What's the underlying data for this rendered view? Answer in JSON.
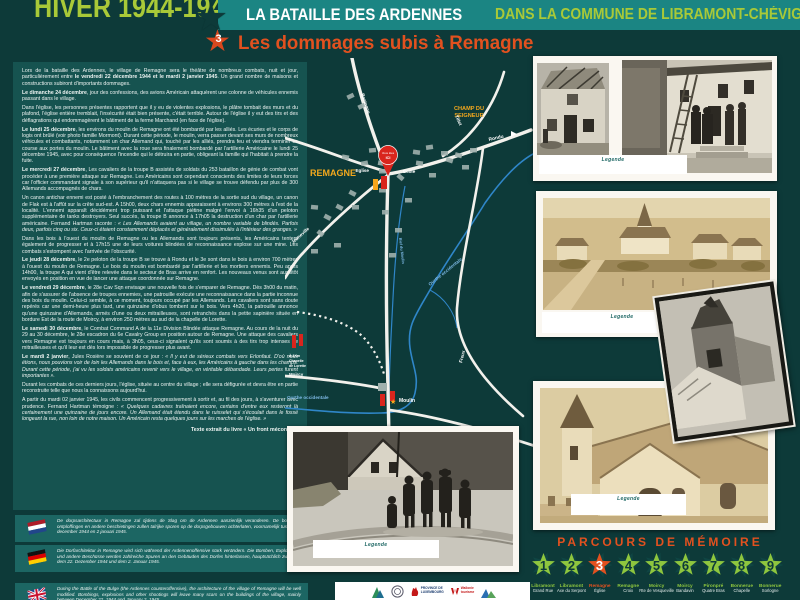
{
  "header": {
    "season_title": "HIVER 1944-1945",
    "battle_title": "LA BATAILLE DES ARDENNES",
    "commune_title": "DANS LA COMMUNE DE LIBRAMONT-CHÉVIGNY",
    "stop_number": "3",
    "page_title": "Les dommages subis à Remagne"
  },
  "article": {
    "paragraphs": [
      {
        "pre": "Lors de la bataille des Ardennes, le village de Remagne sera le théâtre de nombreux combats, nuit et jour, particulièrement entre ",
        "lead": "le vendredi 22 décembre 1944 et le mardi 2 janvier 1945",
        "text": ". Un grand nombre de maisons et constructions subiront d'importants dommages.",
        "quote": ""
      },
      {
        "pre": "",
        "lead": "Le dimanche 24 décembre",
        "text": ", jour des confessions, des avions Américain attaquèrent une colonne de véhicules ennemis passant dans le village.",
        "quote": ""
      },
      {
        "pre": "",
        "lead": "",
        "text": "Dans l'église, les personnes présentes rapportent que il y eu de violentes explosions, le plâtre tombait des murs et du plafond, l'église entière tremblait, l'insécurité était bien présente, c'était terrible. Autour de l'église il y eut des tirs et des déflagrations qui endommagèrent le bâtiment de la ferme Marchand (en face de l'église).",
        "quote": ""
      },
      {
        "pre": "",
        "lead": "Le lundi 25 décembre",
        "text": ", les environs du moulin de Remagne ont été bombardé par les alliés. Les écuries et le corps de logis ont brûlé (voir photo famille Mormont). Durant cette période, le moulin, verra passer devant ses murs de nombreux véhicules et combattants, notamment un char Allemand qui, touché par les alliés, prendra feu et viendra terminer sa course aux portes du moulin. Le bâtiment avec la roue sera finalement bombardé par l'artillerie Américaine le lundi 25 décembre 1945, avec pour conséquence l'incendie qui le détruira en partie, obligeant la famille qui l'habitait à prendre la fuite.",
        "quote": ""
      },
      {
        "pre": "",
        "lead": "Le mercredi 27 décembre",
        "text": ", Les cavaliers de la troupe B assistés de soldats du 253 bataillon de génie de combat vont procéder à une première attaque sur Remagne. Les Américains sont cependant conscients des limites de leurs forces car l'officier commandant signale à son supérieur qu'il n'attaquera pas si le village se trouve défendu par plus de 300 Allemands accompagnés de chars.",
        "quote": ""
      },
      {
        "pre": "",
        "lead": "",
        "text": "Un canon antichar ennemi est posté à l'embranchement des routes à 100 mètres de la sortie sud du village, un canon de Flak est à l'affût sur la crête sud-est. A 15h00, deux chars ennemis apparaissent à environs 300 mètres à l'est de la localité. L'ennemi apparaît décidément trop puissant et l'attaque piétine malgré l'envoi à 16h35 d'un peloton supplémentaire de tanks destroyers. Seul succès, la troupe B annonce à 17h05 la destruction d'un char par l'artillerie américaine. Fernand Hartman raconte : ",
        "quote": "« Les Allemands avaient au village, un nombre variable de blindés. Parfois deux, parfois cinq ou six. Ceux-ci étaient constamment déplacés et généralement dissimulés à l'intérieur des granges. »"
      },
      {
        "pre": "",
        "lead": "",
        "text": "Dans les bois à l'ouest du moulin de Remagne ou les Allemands sont toujours présents, les Américains tentent également de progresser et à 17h15 une de leurs voitures blindées de reconnaissance explose sur une mine. Les combats s'estompent avec l'arrivée de l'obscurité.",
        "quote": ""
      },
      {
        "pre": "",
        "lead": "Le jeudi 28 décembre",
        "text": ", le 2e peloton de la troupe B se trouve à Rondu et le 3e sont dans le bois à environ 700 mètres à l'ouest du moulin de Remagne. Le bois du moulin est bombardé par l'artillerie et les mortiers ennemis. Peu après 14h00, la troupe A qui vient d'être relevée dans le secteur de Bras arrive en renfort. Les nouveaux venus sont aussitôt envoyés en position en vue de lancer une attaque coordonnée sur Remagne.",
        "quote": ""
      },
      {
        "pre": "",
        "lead": "Le vendredi 29 décembre",
        "text": ", le 28e Cav Sqn envisage une nouvelle fois de s'emparer de Remagne. Dès 3h00 du matin, afin de s'assurer de l'absence de troupes ennemies, une patrouille exécute une reconnaissance dans la partie inconnue des bois du moulin. Celui-ci semble, à ce moment, toujours occupé par les Allemands. Les cavaliers sont sans doute repérés car une demi-heure plus tard, une quinzaine d'obus tombent sur le bois. Vers 4h20, la patrouille annonce qu'une quinzaine d'Allemands, armés d'une ou deux mitrailleuses, sont retranchés dans la petite sapinière située en bordure Est de la route de Moircy, à environ 250 mètres au sud de la chapelle de Lorette.",
        "quote": ""
      },
      {
        "pre": "",
        "lead": "Le samedi 30 décembre",
        "text": ", le Combat Command A de la 11e Division Blindée attaque Remagne. Au cours de la nuit du 29 au 30 décembre, le 28e escadron du 6e Cavalry Group en position autour de Remagne. Une attaque des cavaliers vers Remagne est toujours en cours mais, à 3h05, ceux-ci signalent qu'ils sont soumis à des tirs trop intenses de mitrailleuses et qu'il leur est dès lors impossible de progresser plus avant.",
        "quote": ""
      },
      {
        "pre": "",
        "lead": "Le mardi 2 janvier",
        "text": ", Jules Rosière se souvient de ce jour : ",
        "quote": "« Il y eut de sérieux combats vers Erlonfaut. D'où nous étions, nous pouvions voir de loin les Allemands dans le bois et, face à eux, les Américains à gauche dans les champs. Durant cette période, j'ai vu les soldats américains revenir vers le village, en véritable débandade. Leurs pertes furent importantes »."
      },
      {
        "pre": "",
        "lead": "",
        "text": "Durant les combats de ces derniers jours, l'église, située au centre du village ; elle sera défigurée et devra être en partie reconstruite telle que nous la connaissons aujourd'hui.",
        "quote": ""
      },
      {
        "pre": "",
        "lead": "",
        "text": "A partir du mardi 02 janvier 1945, les civils commencent progressivement à sortir et, au fil des jours, à s'aventurer avec prudence. Fernand Hartman témoigne : ",
        "quote": "« Quelques cadavres traînaient encore, certains d'entre eux resteront là certainement une quinzaine de jours encore. Un Allemand était étendu dans le ruisselet qui s'écoulait dans le fossé longeant la rue, non loin de notre maison. Un Américain resta quelques jours sur les marches de l'église. »"
      }
    ],
    "credit": "Texte extrait du livre « Un front méconnu »"
  },
  "translations": [
    {
      "lang": "nl",
      "text": "De dorpsarchitectuur in Remagne zal tijdens de Slag om de Ardennen aanzienlijk veranderen. De bommen, ontploffingen en andere beschietingen zullen talrijke sporen op de dorpsgebouwen achterlaten, voornamelijk tussen 22 december 1944 en 2 januari 1945."
    },
    {
      "lang": "de",
      "text": "Die Dorfarchitektur in Remagne wird sich während der Ardennenoffensive stark verändern. Die Bomben, Explosionen und andere Beschüsse werden zahlreiche Spuren an den Gebäuden des Dorfes hinterlassen, hauptsächlich zwischen dem 22. Dezember 1944 und dem 2. Januar 1945."
    },
    {
      "lang": "en",
      "text": "During the Battle of the Bulge (the Ardennes counteroffensive), the architecture of the village of Remagne will be well modified. Bombings, explosions and other shootings will leave many scars on the buildings of the village, mainly between December 22, 1944 and January 2, 1945."
    }
  ],
  "map": {
    "town": "REMAGNE",
    "field1": "CHAMP DU",
    "field2": "SEIGNEUR",
    "church": "Eglise",
    "school": "Ecole",
    "mill": "Moulin",
    "pin1": "Vous êtes",
    "pin2": "ICI",
    "roads": {
      "north": "Bastogne",
      "northeast": "Tillet",
      "east": "Rondu",
      "southeast": "Freux",
      "south": "Bougnimont",
      "southwest": "Jenneville",
      "west": "Moircy"
    },
    "river": "Ourthe occidentale",
    "stream": "Bief du Moulin",
    "note1": "À 1Km",
    "note2": "Chapelle",
    "note3": "de Lorette"
  },
  "photos": {
    "captions": [
      "Legende",
      "Legende",
      "Legende",
      "Legende"
    ]
  },
  "parcours": {
    "title": "PARCOURS DE MÉMOIRE",
    "stops": [
      {
        "num": "1",
        "name": "Libramont",
        "place": "Grand Rue",
        "active": false
      },
      {
        "num": "2",
        "name": "Libramont",
        "place": "Axe du Serpont",
        "active": false
      },
      {
        "num": "3",
        "name": "Remagne",
        "place": "Église",
        "active": true
      },
      {
        "num": "4",
        "name": "Remagne",
        "place": "Croix",
        "active": false
      },
      {
        "num": "5",
        "name": "Moircy",
        "place": "Rte de Vesqueville",
        "active": false
      },
      {
        "num": "6",
        "name": "Moircy",
        "place": "Bandavin",
        "active": false
      },
      {
        "num": "7",
        "name": "Pironpré",
        "place": "Quatre Bras",
        "active": false
      },
      {
        "num": "8",
        "name": "Bonnerue",
        "place": "Chapelle",
        "active": false
      },
      {
        "num": "9",
        "name": "Bonnerue",
        "place": "Sorlogne",
        "active": false
      }
    ]
  },
  "footer": {
    "province_line1": "PROVINCE DE",
    "province_line2": "LUXEMBOURG",
    "wallonie_line1": "Wallonie",
    "wallonie_line2": "tourisme"
  },
  "colors": {
    "green": "#a9c938",
    "orange": "#e2511f",
    "star_green": "#8ec63e",
    "map_label_orange": "#f3a81d"
  }
}
